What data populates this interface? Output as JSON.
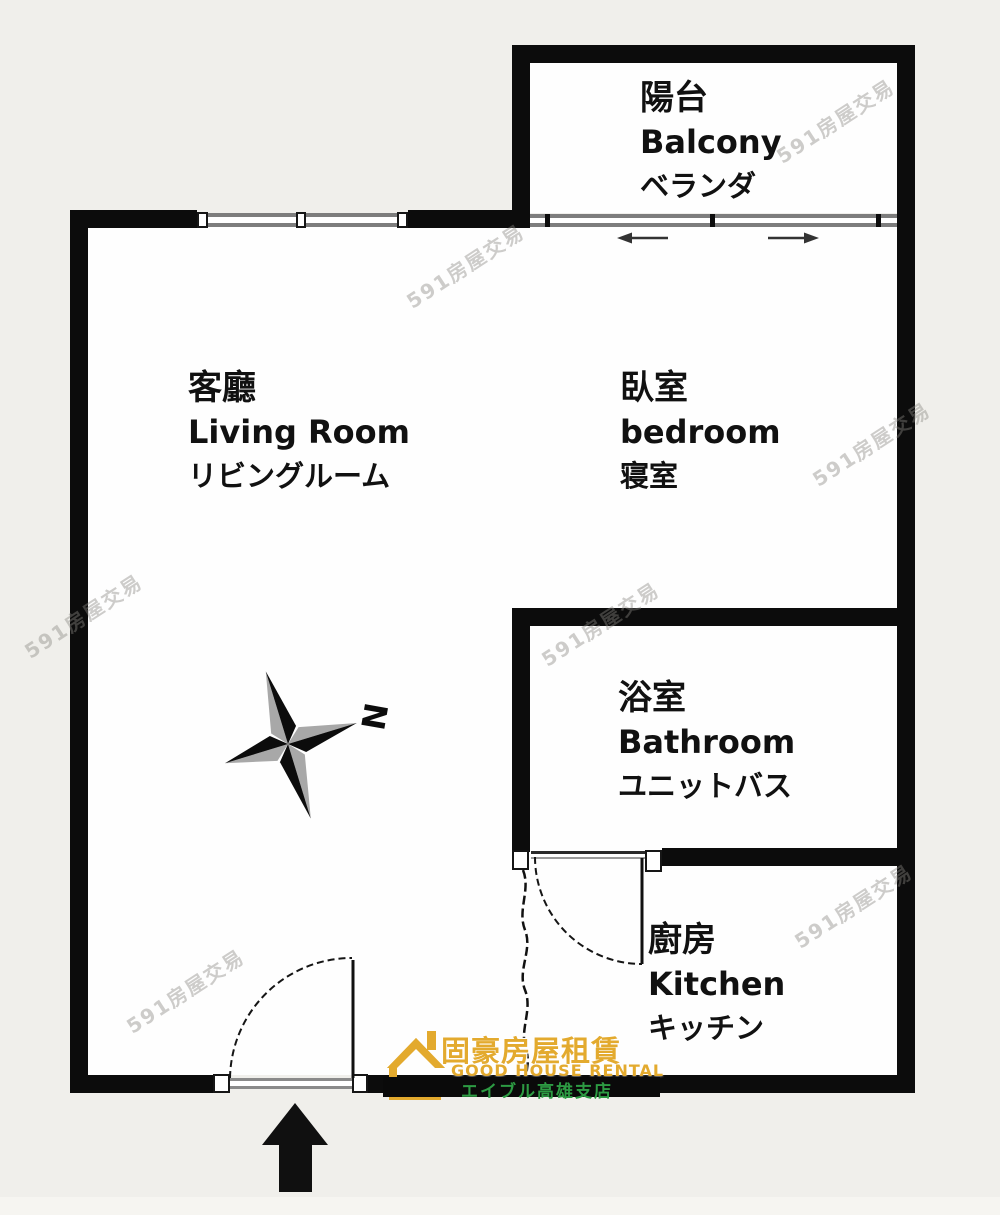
{
  "image_type": "apartment floor plan",
  "rooms": {
    "balcony": {
      "zh": "陽台",
      "en": "Balcony",
      "ja": "ベランダ"
    },
    "living": {
      "zh": "客廳",
      "en": "Living Room",
      "ja": "リビングルーム"
    },
    "bedroom": {
      "zh": "臥室",
      "en": "bedroom",
      "ja": "寝室"
    },
    "bathroom": {
      "zh": "浴室",
      "en": "Bathroom",
      "ja": "ユニットバス"
    },
    "kitchen": {
      "zh": "廚房",
      "en": "Kitchen",
      "ja": "キッチン"
    }
  },
  "compass": {
    "north_label": "N"
  },
  "logo": {
    "company_zh": "固豪房屋租賃",
    "company_en": "GOOD HOUSE RENTAL",
    "branch_ja": "エイブル高雄支店"
  },
  "watermark": {
    "text": "591房屋交易"
  },
  "colors": {
    "wall": "#0c0c0c",
    "background": "#f0efeb",
    "floor": "#fefefe",
    "window_line": "#7d7d7d",
    "logo_gold": "#e3aa2e",
    "logo_green": "#2d9b43"
  }
}
